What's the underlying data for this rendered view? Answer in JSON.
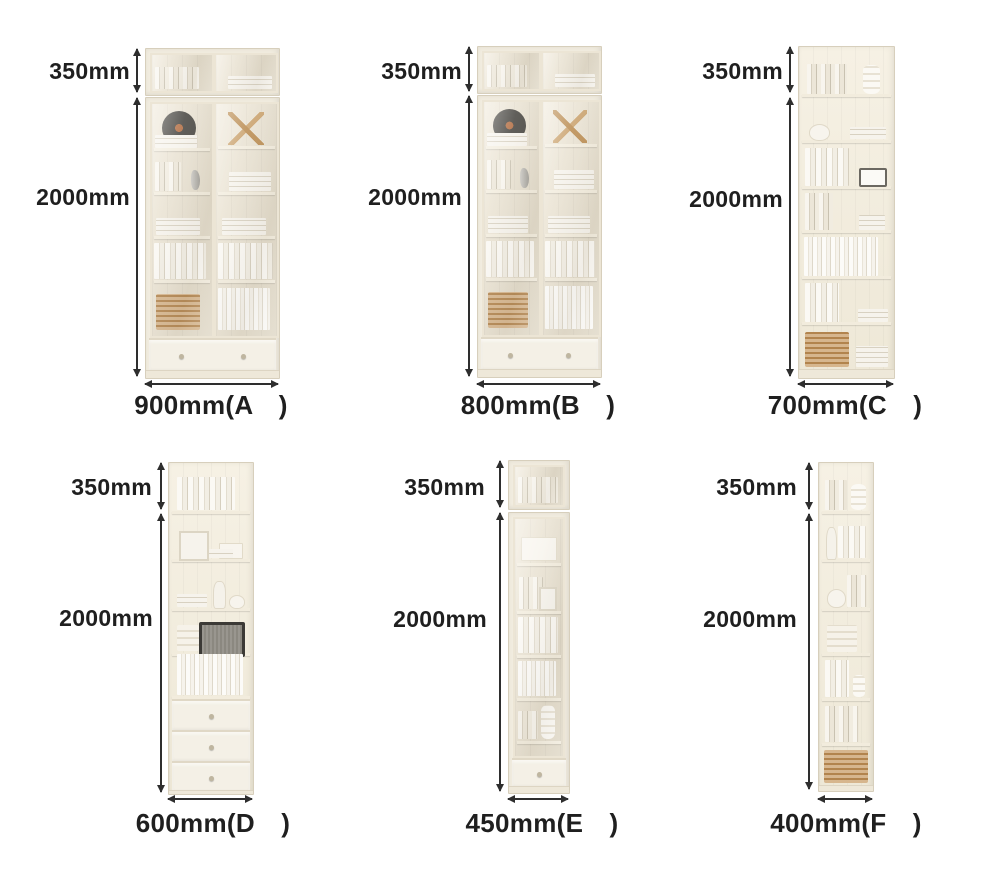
{
  "page": {
    "background": "#ffffff"
  },
  "colors": {
    "text": "#1f1f1f",
    "arrow": "#2e2e2e",
    "cabinet_frame": "#f1ecdf",
    "cabinet_border": "#d7cfbc",
    "glass_tint": "#e3dccb",
    "basket": "#c79a62",
    "record": "#44423d"
  },
  "cabinets": [
    {
      "id": "A",
      "top_dim": "350mm",
      "height_dim": "2000mm",
      "width_label": "900mm(A　)",
      "width_mm": 900,
      "top_mm": 350,
      "height_mm": 2000,
      "style": "two-glass-door bookcase with bottom drawer"
    },
    {
      "id": "B",
      "top_dim": "350mm",
      "height_dim": "2000mm",
      "width_label": "800mm(B　)",
      "width_mm": 800,
      "top_mm": 350,
      "height_mm": 2000,
      "style": "two-glass-door bookcase with bottom drawer"
    },
    {
      "id": "C",
      "top_dim": "350mm",
      "height_dim": "2000mm",
      "width_label": "700mm(C　)",
      "width_mm": 700,
      "top_mm": 350,
      "height_mm": 2000,
      "style": "open bookshelf with seven shelves"
    },
    {
      "id": "D",
      "top_dim": "350mm",
      "height_dim": "2000mm",
      "width_label": "600mm(D　)",
      "width_mm": 600,
      "top_mm": 350,
      "height_mm": 2000,
      "style": "open shelves with three bottom drawers"
    },
    {
      "id": "E",
      "top_dim": "350mm",
      "height_dim": "2000mm",
      "width_label": "450mm(E　)",
      "width_mm": 450,
      "top_mm": 350,
      "height_mm": 2000,
      "style": "single glass door cabinet with bottom drawer"
    },
    {
      "id": "F",
      "top_dim": "350mm",
      "height_dim": "2000mm",
      "width_label": "400mm(F　)",
      "width_mm": 400,
      "top_mm": 350,
      "height_mm": 2000,
      "style": "narrow open bookshelf"
    }
  ]
}
